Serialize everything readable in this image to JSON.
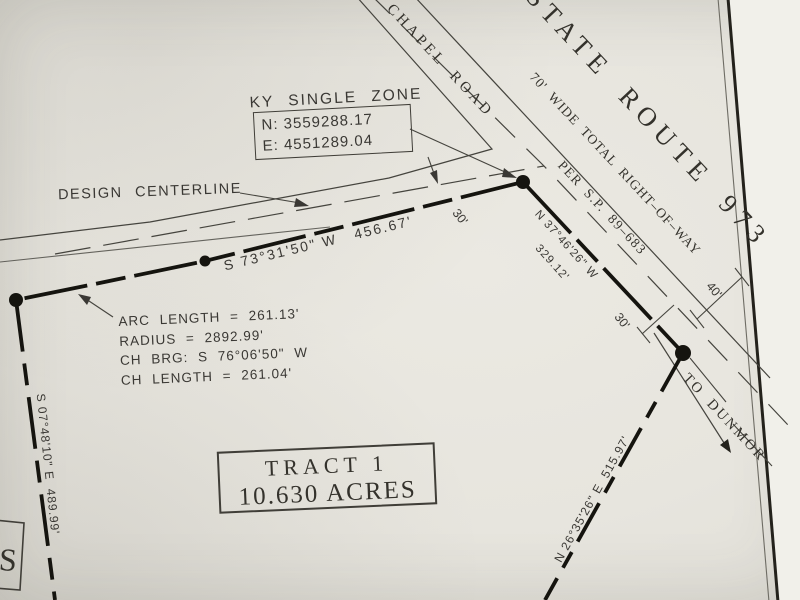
{
  "colors": {
    "paper": "#e7e5de",
    "ink": "#3a3834",
    "boundary": "#15140f"
  },
  "boxes": {
    "ky_zone": {
      "title": "KY SINGLE ZONE",
      "line1": "N: 3559288.17",
      "line2": "E: 4551289.04"
    },
    "tract": {
      "line1": "TRACT 1",
      "line2": "10.630 ACRES"
    },
    "corner_letter": "S"
  },
  "roads": {
    "design_centerline": "DESIGN CENTERLINE",
    "chapel": "S CHAPEL ROAD",
    "state_route": "STATE ROUTE 973",
    "row_width": "70' WIDE TOTAL RIGHT–OF–WAY",
    "per_sp": "PER S.P. 89–683",
    "to_dunmor": "TO DUNMOR"
  },
  "bearings": {
    "north_frontage": "S 73°31'50\" W   456.67'",
    "highway_1": "N 37°46'26\" W",
    "highway_2": "329.12'",
    "southeast": "N 26°35'26\" E  515.97'",
    "west": "S 07°48'10\" E  489.99'"
  },
  "curve": {
    "arc_length": "ARC LENGTH = 261.13'",
    "radius": "RADIUS = 2892.99'",
    "chord_bearing": "CH BRG: S 76°06'50\" W",
    "chord_length": "CH LENGTH = 261.04'"
  },
  "dimensions": {
    "d30": "30'",
    "d40": "40'"
  },
  "tract_label": {
    "name": "TRACT 1",
    "area_acres": "10.630 ACRES"
  }
}
